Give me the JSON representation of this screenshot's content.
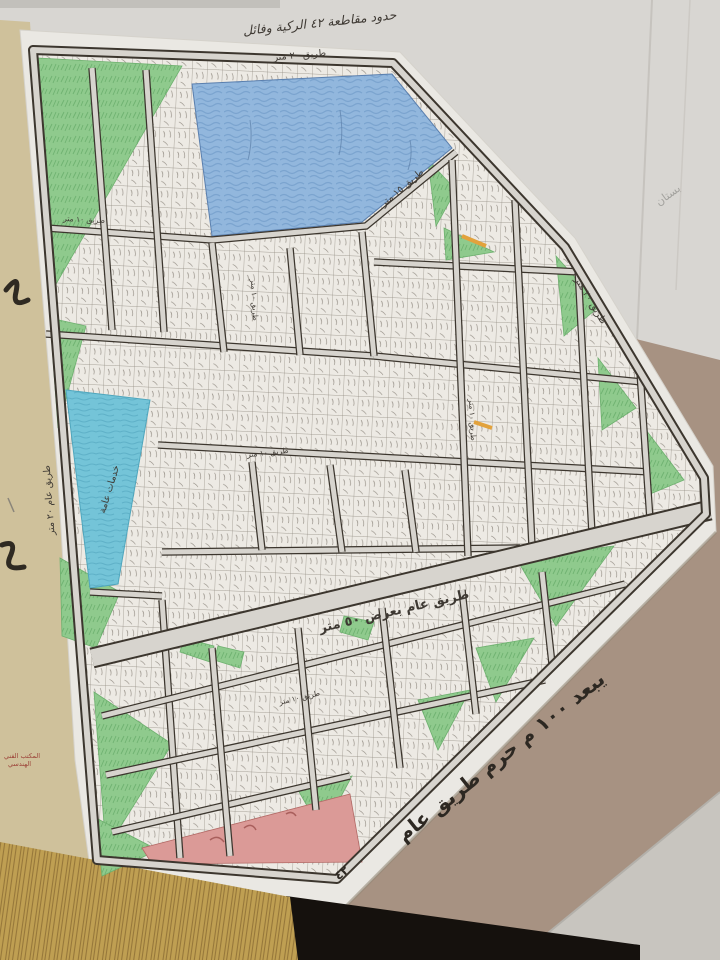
{
  "meta": {
    "description": "Photograph of a hand-drawn land subdivision map (district plan) on white paper laid over cardboard and old papers",
    "district_number": "٤٢"
  },
  "labels": {
    "title": "حدود مقاطعة ٤٢ الركية وفائل",
    "road_top_20": "طريق ٢٠ متر",
    "road_right_20": "طريق ٢٠ متر",
    "road_left_20": "طريق عام ٢٠ متر",
    "road_15": "طريق ١٥ متر",
    "road_50": "طريق عام بعرض ٥٠ متر",
    "road_10": "طريق ١٠ متر",
    "services": "خدمات عامة",
    "orchard": "بستان",
    "cardboard_note": "يبعد ١٠٠ م حرم طريق عام",
    "cardboard_mark": "٤٢",
    "stamp_1": "المكتب الفني",
    "stamp_2": "الهندسي"
  },
  "colors": {
    "map_paper": "#eae8e3",
    "side_paper_yellow": "#cfc19b",
    "background_paper": "#d8d6d2",
    "cardboard": "#a79282",
    "table_black": "#15110d",
    "wood_edge": "#bf9f52",
    "water_north": "#92b7dd",
    "water_west": "#74c4d8",
    "green_area": "#8fca8d",
    "red_area": "#db9a97",
    "road_fill": "#d7d4ce",
    "ink": "#3c362e"
  }
}
